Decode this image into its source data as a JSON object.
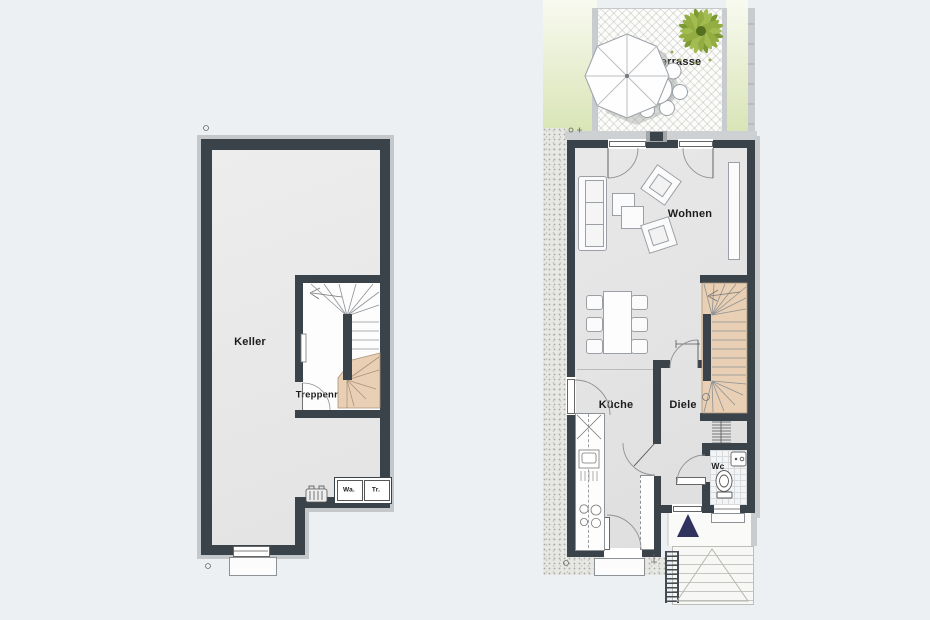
{
  "page": {
    "background_color": "#edf0f3"
  },
  "basement_plan": {
    "rooms": {
      "keller": "Keller",
      "treppenraum": "Treppenr."
    },
    "appliances": {
      "washer_short": "Wa.",
      "dryer_short": "Tr."
    }
  },
  "ground_floor_plan": {
    "rooms": {
      "terrasse": "Terrasse",
      "wohnen": "Wohnen",
      "kueche": "Küche",
      "diele": "Diele",
      "wc": "Wc"
    }
  },
  "colors": {
    "wall": "#3a424a",
    "stair_fill": "#e9cfb3",
    "lawn": "#dbe5ba",
    "gravel": "#e7e7e4",
    "entrance_marker": "#31335f"
  }
}
